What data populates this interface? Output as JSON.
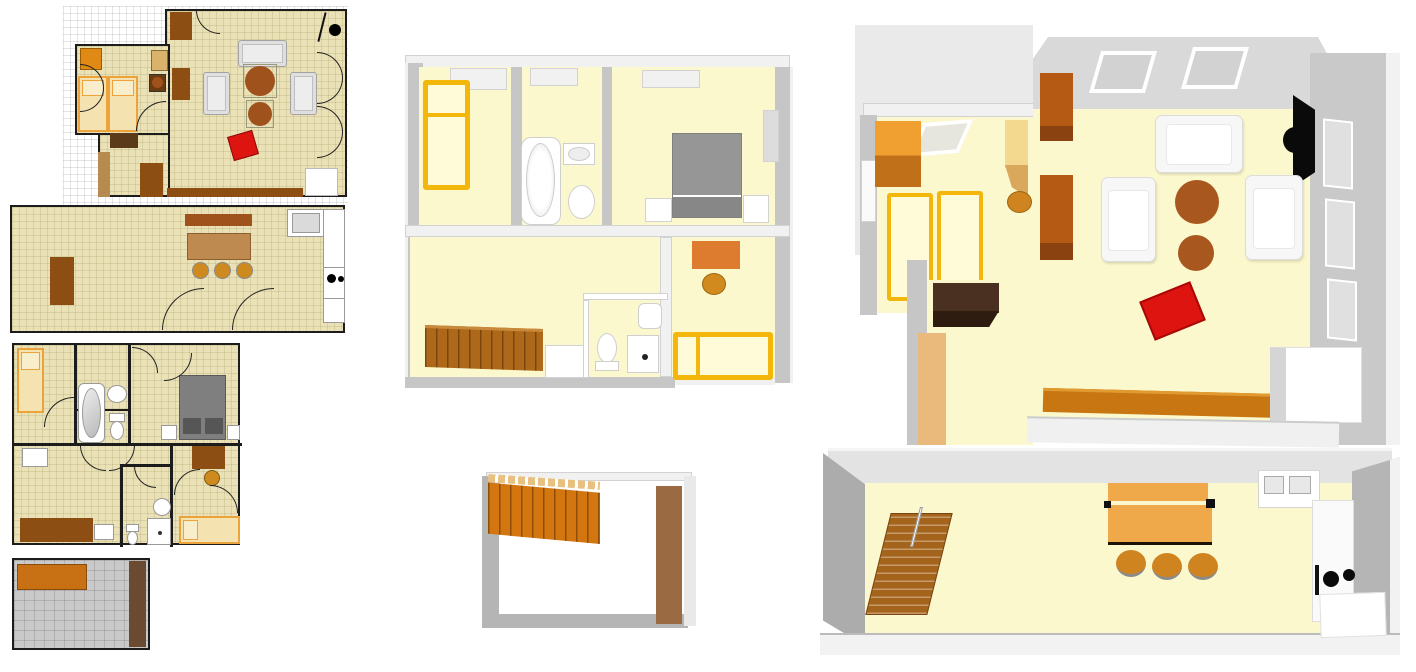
{
  "app": {
    "title": "Home floor plan collage — 2D plans and 3D aerial views",
    "background": "#FFFFFF",
    "visible_text": ""
  },
  "palette": {
    "floor2d": "#EAE2B6",
    "wall2d": "#1C1C1C",
    "graph": "#DCDCDC",
    "floor3d": "#FCF8CD",
    "wall3d": "#C6C6C6",
    "wall3dlight": "#EFEFEF",
    "brown": "#8C4E12",
    "brownmid": "#A0521D",
    "darkwood": "#4A3020",
    "tan": "#D9B36C",
    "orange": "#E08914",
    "gold": "#F2B70A",
    "bedfill": "#FFFBD8",
    "red": "#DE1410",
    "graybed": "#969696",
    "sofa3d": "#F7F7F7",
    "sofa2d": "#DFDFDF",
    "dining": "#EFA94A",
    "stool": "#CE8A1E",
    "stairs2d": "#C87014",
    "stairs3d": "#AE681A",
    "woodbar": "#C87612",
    "doortan": "#E9BA7C",
    "floorgray": "#C9C9C9",
    "backdrop": "#EAEAEA"
  },
  "panels": [
    {
      "id": "plan-2d-ground-living",
      "type": "2d-plan",
      "label": "2D plan — ground floor living room and bedroom on graph paper",
      "items": [
        "graph-paper-grid",
        "living-room",
        "bedroom",
        "double-bed",
        "wardrobe",
        "desk",
        "stool",
        "sofa",
        "armchair",
        "armchair",
        "round-table",
        "round-table",
        "red-chair",
        "tv",
        "cabinet",
        "sideboard",
        "doors"
      ]
    },
    {
      "id": "plan-2d-kitchen",
      "type": "2d-plan",
      "label": "2D plan — long kitchen/dining room",
      "items": [
        "cabinet",
        "sideboard",
        "dining-table",
        "stool",
        "stool",
        "stool",
        "sink-unit",
        "counter",
        "stove",
        "door",
        "door"
      ]
    },
    {
      "id": "plan-2d-upper",
      "type": "2d-plan",
      "label": "2D plan — upper floor with bathroom, bedrooms and WC",
      "items": [
        "single-bed",
        "bathtub",
        "sink",
        "toilet",
        "double-bed-gray",
        "nightstand",
        "nightstand",
        "desk",
        "stool",
        "wardrobe",
        "toilet",
        "sink",
        "shower",
        "single-bed",
        "doors"
      ]
    },
    {
      "id": "plan-2d-basement",
      "type": "2d-plan",
      "label": "2D plan — basement room with stairs",
      "items": [
        "stairs",
        "door-panel"
      ]
    },
    {
      "id": "view-3d-upper",
      "type": "3d-view",
      "label": "3D aerial view — upper floor",
      "items": [
        "single-bed-yellow",
        "window",
        "bathtub",
        "sink",
        "toilet",
        "double-bed-gray",
        "nightstand",
        "nightstand",
        "window",
        "desk-orange",
        "stool",
        "stairs",
        "white-cabinet",
        "toilet",
        "shower",
        "sink",
        "single-bed-yellow"
      ]
    },
    {
      "id": "view-3d-basement",
      "type": "3d-view",
      "label": "3D aerial view — basement with stairs",
      "items": [
        "stairs-orange",
        "door-panel-brown"
      ]
    },
    {
      "id": "view-3d-living",
      "type": "3d-view",
      "label": "3D aerial view — ground floor living room and bedroom",
      "items": [
        "wardrobe-cube",
        "skylight",
        "twin-bed",
        "twin-bed",
        "desk",
        "stool",
        "door",
        "dresser",
        "door-panel",
        "window",
        "window",
        "tv",
        "cabinet",
        "cabinet",
        "sofa",
        "armchair",
        "armchair",
        "round-table",
        "round-table",
        "red-chair",
        "sideboard",
        "white-cabinet"
      ]
    },
    {
      "id": "view-3d-kitchen",
      "type": "3d-view",
      "label": "3D aerial view — kitchen/dining room",
      "items": [
        "stairs",
        "dining-table",
        "stool",
        "stool",
        "stool",
        "sink-unit",
        "counter",
        "stove",
        "cabinet"
      ]
    }
  ]
}
